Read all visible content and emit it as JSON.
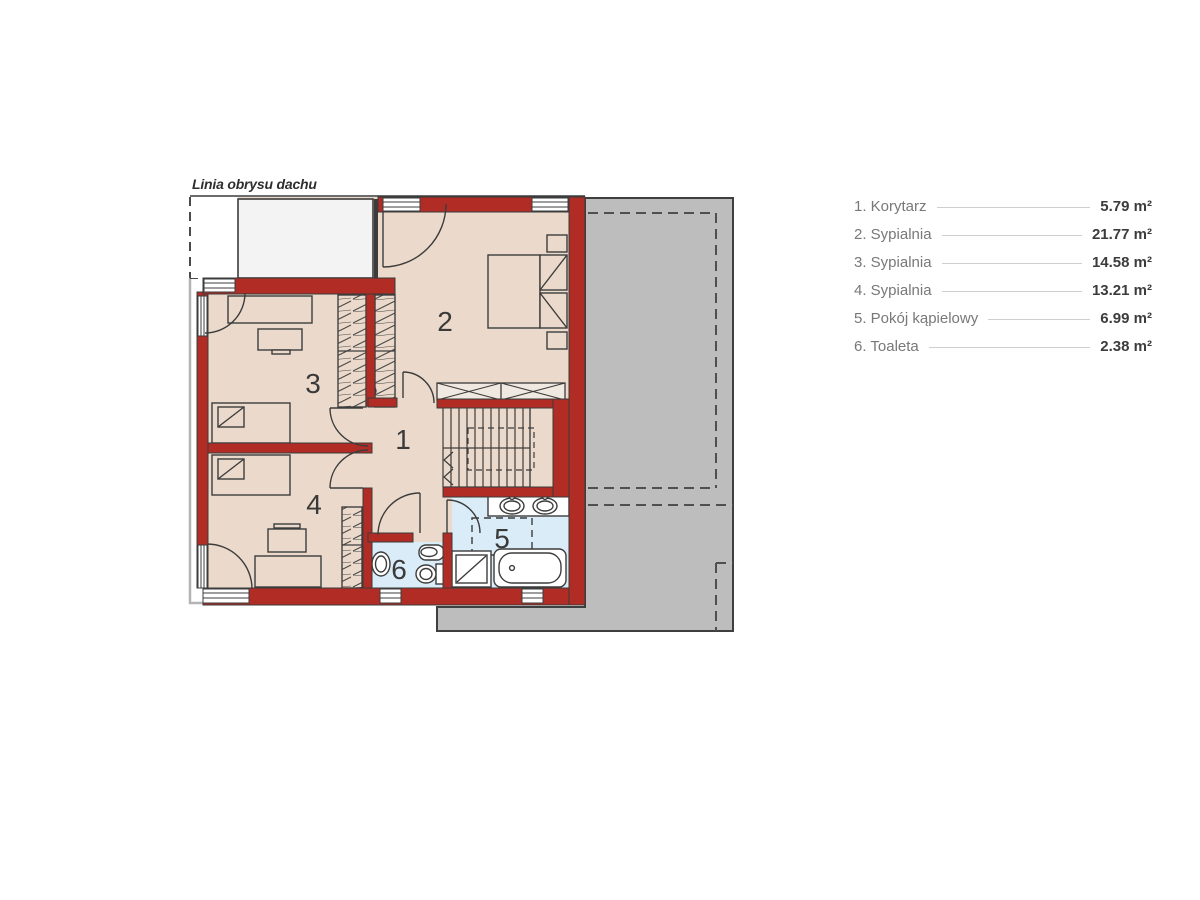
{
  "roof_outline_label": "Linia obrysu dachu",
  "plan": {
    "rooms": [
      {
        "number": "1",
        "name": "Korytarz",
        "area": "5.79 m²"
      },
      {
        "number": "2",
        "name": "Sypialnia",
        "area": "21.77 m²"
      },
      {
        "number": "3",
        "name": "Sypialnia",
        "area": "14.58 m²"
      },
      {
        "number": "4",
        "name": "Sypialnia",
        "area": "13.21 m²"
      },
      {
        "number": "5",
        "name": "Pokój kąpielowy",
        "area": "6.99 m²"
      },
      {
        "number": "6",
        "name": "Toaleta",
        "area": "2.38 m²"
      }
    ],
    "colors": {
      "wall_red": "#b22c26",
      "floor_beige": "#ebdacb",
      "bathroom_blue": "#d9ecf7",
      "roof_gray": "#bdbdbd",
      "line_dark": "#3c3c3c",
      "white_area": "#f3f3f3"
    }
  },
  "legend": {
    "items": [
      {
        "label": "1. Korytarz",
        "value": "5.79 m²"
      },
      {
        "label": "2. Sypialnia",
        "value": "21.77 m²"
      },
      {
        "label": "3. Sypialnia",
        "value": "14.58 m²"
      },
      {
        "label": "4. Sypialnia",
        "value": "13.21 m²"
      },
      {
        "label": "5. Pokój kąpielowy",
        "value": "6.99 m²"
      },
      {
        "label": "6. Toaleta",
        "value": "2.38 m²"
      }
    ]
  }
}
